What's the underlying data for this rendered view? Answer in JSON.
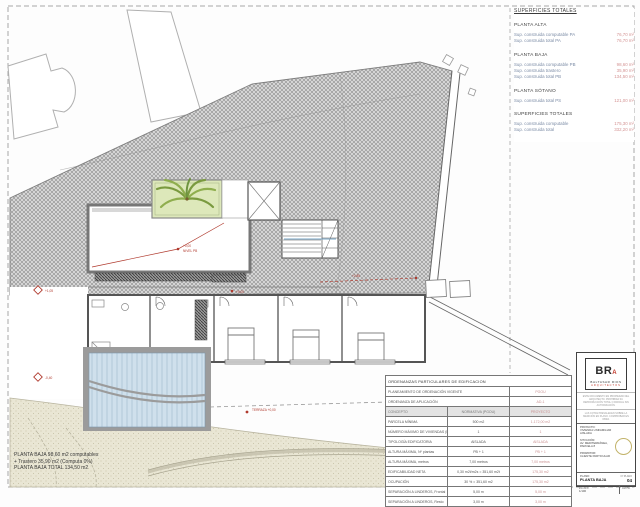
{
  "surfaces": {
    "title": "SUPERFICIES TOTALES",
    "sections": [
      {
        "heading": "PLANTA ALTA",
        "rows": [
          [
            "Sup. construida computable PA",
            "76,70 m²"
          ],
          [
            "Sup. construida total PA",
            "76,70 m²"
          ]
        ]
      },
      {
        "heading": "PLANTA BAJA",
        "rows": [
          [
            "Sup. construida computable PB",
            "98,60 m²"
          ],
          [
            "Sup. construida trastero",
            "35,90 m²"
          ],
          [
            "Sup. construida total PB",
            "134,50 m²"
          ]
        ]
      },
      {
        "heading": "PLANTA SÓTANO",
        "rows": [
          [
            "Sup. construida total PS",
            "121,00 m²"
          ]
        ]
      },
      {
        "heading": "SUPERFICIES TOTALES",
        "rows": [
          [
            "Sup. construida computable",
            "175,30 m²"
          ],
          [
            "Sup. construida total",
            "332,20 m²"
          ]
        ]
      }
    ]
  },
  "note": {
    "line1": "PLANTA BAJA 98,60 m2 computables",
    "line2": "+ Trastero 35,90 m2 (Computa 0%)",
    "line3": "PLANTA BAJA TOTAL  134,50 m2"
  },
  "ordenanzas": {
    "title": "ORDENANZAS PARTICULARES DE EDIFICACION",
    "pre_rows": [
      [
        "PLANEAMIENTO DE ORDENACIÓN VIGENTE",
        "PGOU"
      ],
      [
        "ORDENANZA DE APLICACIÓN",
        "AD-1"
      ]
    ],
    "header": [
      "CONCEPTO",
      "NORMATIVA (PGOU)",
      "PROYECTO"
    ],
    "rows": [
      [
        "PARCELA MÍNIMA",
        "500 m2",
        "1.172,00 m2"
      ],
      [
        "NÚMERO MÁXIMO DE VIVIENDAS (Nº viv/parcela)",
        "1",
        "1"
      ],
      [
        "TIPOLOGÍA EDIFICATORIA",
        "AISLADA",
        "AISLADA"
      ],
      [
        "ALTURA MÁXIMA, Nº plantas",
        "PB + 1",
        "PB + 1"
      ],
      [
        "ALTURA MÁXIMA, metros",
        "7,00 metros",
        "7,00 metros"
      ],
      [
        "EDIFICABILIDAD NETA",
        "0,30 m2t/m2s = 351,60 m2t",
        "175,30 m2"
      ],
      [
        "OCUPACIÓN",
        "30 % = 351,60 m2",
        "175,30 m2"
      ],
      [
        "SEPARACIÓN A LINDEROS, Frontal",
        "5,00 m",
        "5,00 m"
      ],
      [
        "SEPARACIÓN A LINDEROS, Resto",
        "3,00 m",
        "3,00 m"
      ]
    ]
  },
  "title_block": {
    "logo_initials": "BR",
    "logo_a": "A",
    "studio_name": "BALTASAR RIOS",
    "studio_subtitle": "ARQUITECTOS",
    "fine_print_1": "ESTE DOCUMENTO ES PROPIEDAD DEL ARQUITECTO. PROHIBIDA SU REPRODUCCIÓN TOTAL O PARCIAL SIN AUTORIZACIÓN.",
    "fine_print_2": "LAS COTAS PREVALECEN SOBRE LA MEDICIÓN EN PLANO. COMPROBAR EN OBRA.",
    "fields": [
      {
        "label": "PROYECTO:",
        "value": "VIVIENDA UNIFAMILIAR AISLADA"
      },
      {
        "label": "SITUACIÓN:",
        "value": "AV. MEDITERRÁNEA, PARCELA 8"
      },
      {
        "label": "PROMOTOR:",
        "value": "CLIENTE PARTICULAR"
      }
    ],
    "plano_label": "PLANO:",
    "plano_value": "PLANTA BAJA",
    "num_label": "Nº PLANO",
    "num_value": "04",
    "escala_label": "ESCALA",
    "escala_value": "1/100",
    "fecha_label": "FECHA",
    "fecha_value": ""
  },
  "plan": {
    "annotations": {
      "a1": "+0,00",
      "a2": "NIVEL PB",
      "a3": "+0,00",
      "a4": "TERRAZA +0,00",
      "a5": "+1,05",
      "a6": "-0,40",
      "a7": "+2,85"
    }
  },
  "colors": {
    "accent_red": "#b03a2e",
    "hatch_grey": "#9a9a9a",
    "pool_blue": "#cfe0ec",
    "sand": "#eae7d6",
    "planter_green": "#dde8ba",
    "label_blue": "#7c8ca6",
    "value_red": "#d49494"
  }
}
